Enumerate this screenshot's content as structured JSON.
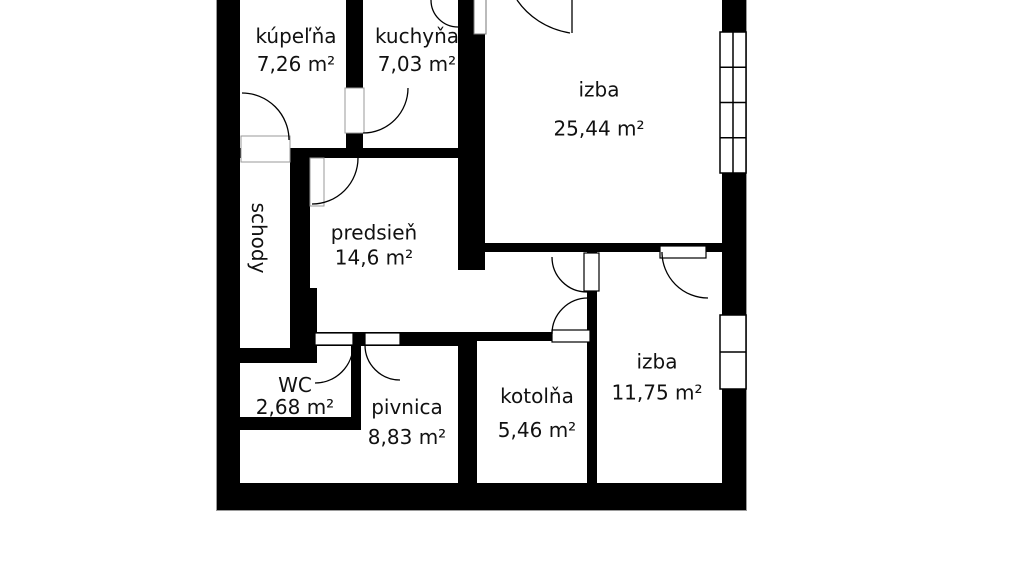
{
  "floor_plan": {
    "rooms": [
      {
        "name": "kúpeľňa",
        "area": "7,26 m²"
      },
      {
        "name": "kuchyňa",
        "area": "7,03 m²"
      },
      {
        "name": "izba",
        "area": "25,44 m²"
      },
      {
        "name": "schody",
        "area": ""
      },
      {
        "name": "predsieň",
        "area": "14,6 m²"
      },
      {
        "name": "WC",
        "area": "2,68 m²"
      },
      {
        "name": "pivnica",
        "area": "8,83 m²"
      },
      {
        "name": "kotolňa",
        "area": "5,46 m²"
      },
      {
        "name": "izba",
        "area": "11,75 m²"
      }
    ],
    "colors": {
      "wall": "#000000",
      "floor": "#ffffff",
      "hairline": "#9a9a9a",
      "text": "#111111"
    }
  }
}
